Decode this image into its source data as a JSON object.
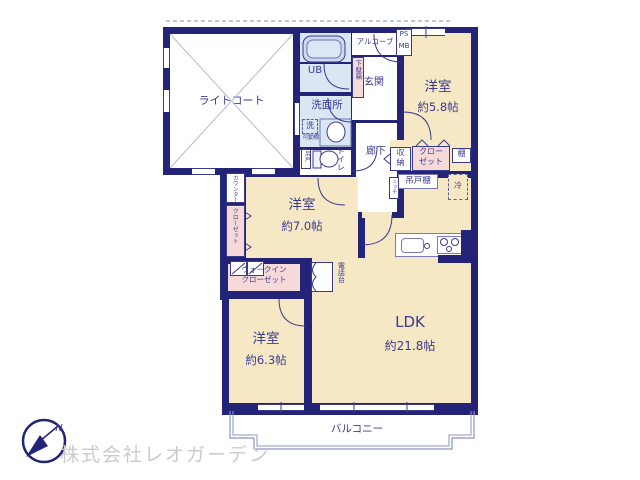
{
  "plan": {
    "rooms": {
      "light_court": {
        "name": "ライトコート"
      },
      "bedroom_58": {
        "name": "洋室",
        "size": "約5.8帖"
      },
      "bedroom_70": {
        "name": "洋室",
        "size": "約7.0帖"
      },
      "bedroom_63": {
        "name": "洋室",
        "size": "約6.3帖"
      },
      "ldk": {
        "name": "LDK",
        "size": "約21.8帖"
      },
      "balcony": {
        "name": "バルコニー"
      }
    },
    "fixtures": {
      "alcove": "アルコーブ",
      "ps": "PS",
      "mb": "MB",
      "entrance": "玄関",
      "shoe_box": "下駄箱",
      "unit_bath": "UB",
      "washroom": "洗面所",
      "washer": "洗",
      "movable_shelf": "可動棚",
      "toilet": "トイレ",
      "hanging_door": "吊戸",
      "hallway": "廊下",
      "storage_top": "収",
      "storage_bottom": "納",
      "closet_line1": "クロー",
      "closet_line2": "ゼット",
      "shelf": "棚",
      "hanging_cupboard": "吊戸棚",
      "refrigerator": "冷",
      "niche": "ニッチ",
      "counter": "カウンター",
      "closet_vertical": "クローゼット",
      "wic_line1": "ウォークイン",
      "wic_line2": "クローゼット",
      "phone_stand": "電話台"
    },
    "compass": {
      "north": "N"
    },
    "footer": {
      "company": "株式会社レオガーデン"
    },
    "colors": {
      "wall": "#232378",
      "room": "#f6e8c4",
      "closet": "#f6dada",
      "wet_area": "#dbe6f3",
      "text": "#3a3a8f",
      "watermark": "#cbcbcb"
    }
  }
}
